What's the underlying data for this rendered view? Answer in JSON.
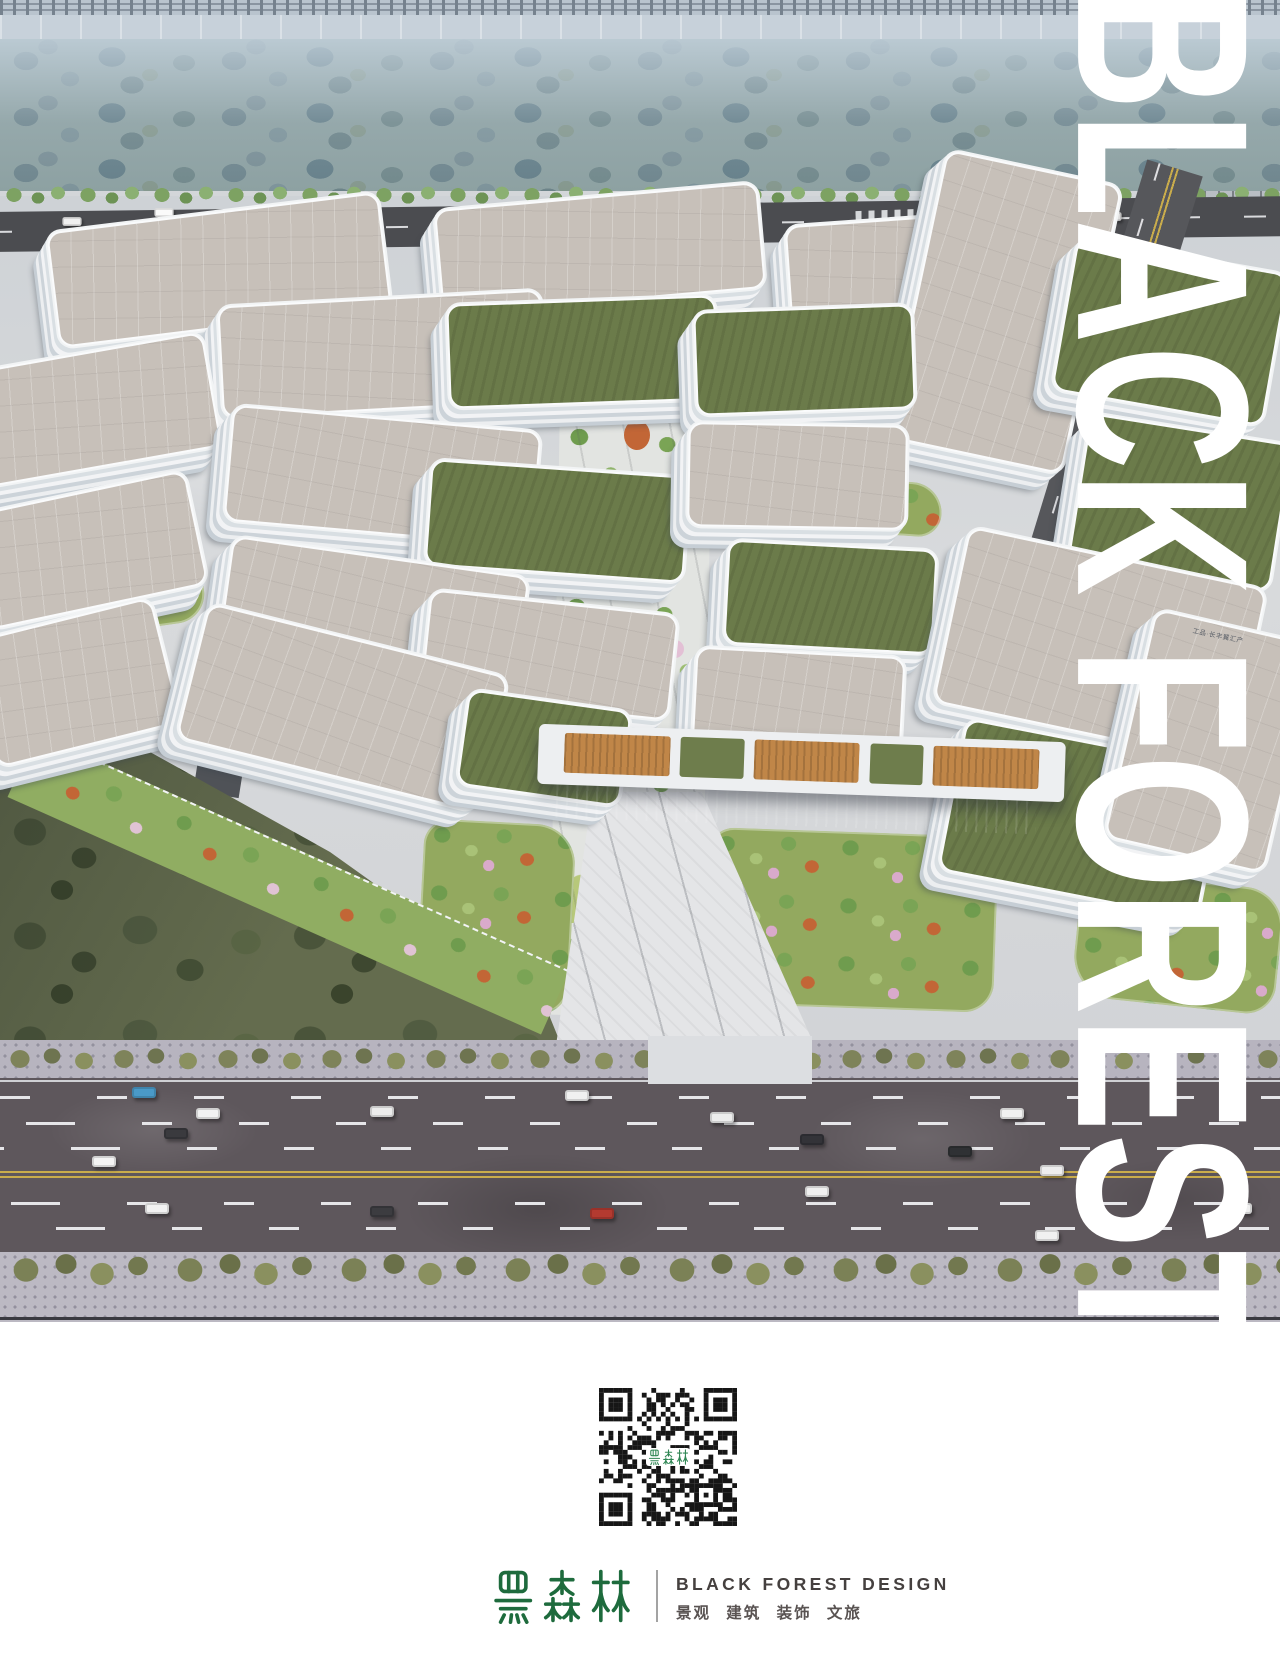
{
  "poster": {
    "watermark_text": "BLACK FOREST",
    "scene": {
      "type": "aerial-architectural-rendering",
      "description": "滨河产业园鸟瞰效果图：白色板式办公楼群、绿色屋顶、中央景观轴、城市干道与河岸绿带",
      "building_signage": "工品·长丰翼汇产"
    },
    "qr": {
      "modules": 29,
      "center_label": "黑森林",
      "dark_color": "#161616",
      "label_color": "#2e8653"
    },
    "brand": {
      "logo_cn": "黑森林",
      "name_en": "BLACK FOREST DESIGN",
      "services_cn": "景观  建筑  装饰  文旅",
      "logo_green": "#1e6b3d",
      "text_dark": "#45403f",
      "text_gray": "#595352",
      "divider_color": "#a3a3a3"
    },
    "palette": {
      "river_band": "#8da1a2",
      "roof_beige": "#c7c0b9",
      "roof_green": "#6b7b4a",
      "facade_white": "#f2f4f5",
      "top_road": "#4b4c50",
      "arterial_road": "#5e575c",
      "lane_yellow": "#c9ac4c",
      "forest_dark": "#4a543a",
      "sidewalk": "#bcb9c3",
      "axis_green": "#93a95f",
      "accent_orange": "#c26636",
      "accent_pink": "#d9aacb",
      "watermark": "#ffffff"
    }
  }
}
